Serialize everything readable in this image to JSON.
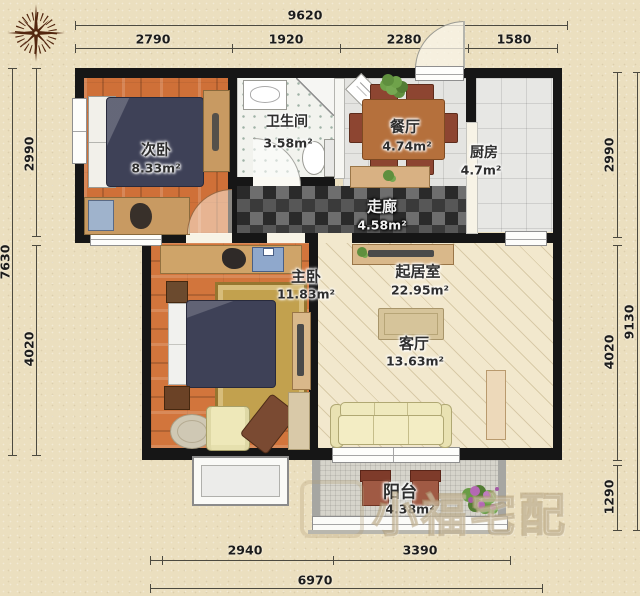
{
  "watermark": "小福宅配",
  "rooms": [
    {
      "name": "次卧",
      "area": "8.33m²"
    },
    {
      "name": "卫生间",
      "area": "3.58m²"
    },
    {
      "name": "餐厅",
      "area": "4.74m²"
    },
    {
      "name": "厨房",
      "area": "4.7m²"
    },
    {
      "name": "走廊",
      "area": "4.58m²"
    },
    {
      "name": "主卧",
      "area": "11.83m²"
    },
    {
      "name": "起居室",
      "area": "22.95m²"
    },
    {
      "name": "客厅",
      "area": "13.63m²"
    },
    {
      "name": "阳台",
      "area": "4.38m²"
    }
  ],
  "dims": {
    "top_total": "9620",
    "top_segments": [
      "2790",
      "1920",
      "2280",
      "1580"
    ],
    "left_total": "7630",
    "left_segments": [
      "2990",
      "4020"
    ],
    "right_total": "9130",
    "right_segments": [
      "2990",
      "4020",
      "1290"
    ],
    "bottom_total": "6970",
    "bottom_segments": [
      "2940",
      "3390"
    ]
  },
  "colors": {
    "wall": "#161616",
    "wood_floor": "#cf7038",
    "corridor_tile": "#3a3a3a",
    "living_floor": "#f2e8cd",
    "paper": "#ebdfbf"
  }
}
